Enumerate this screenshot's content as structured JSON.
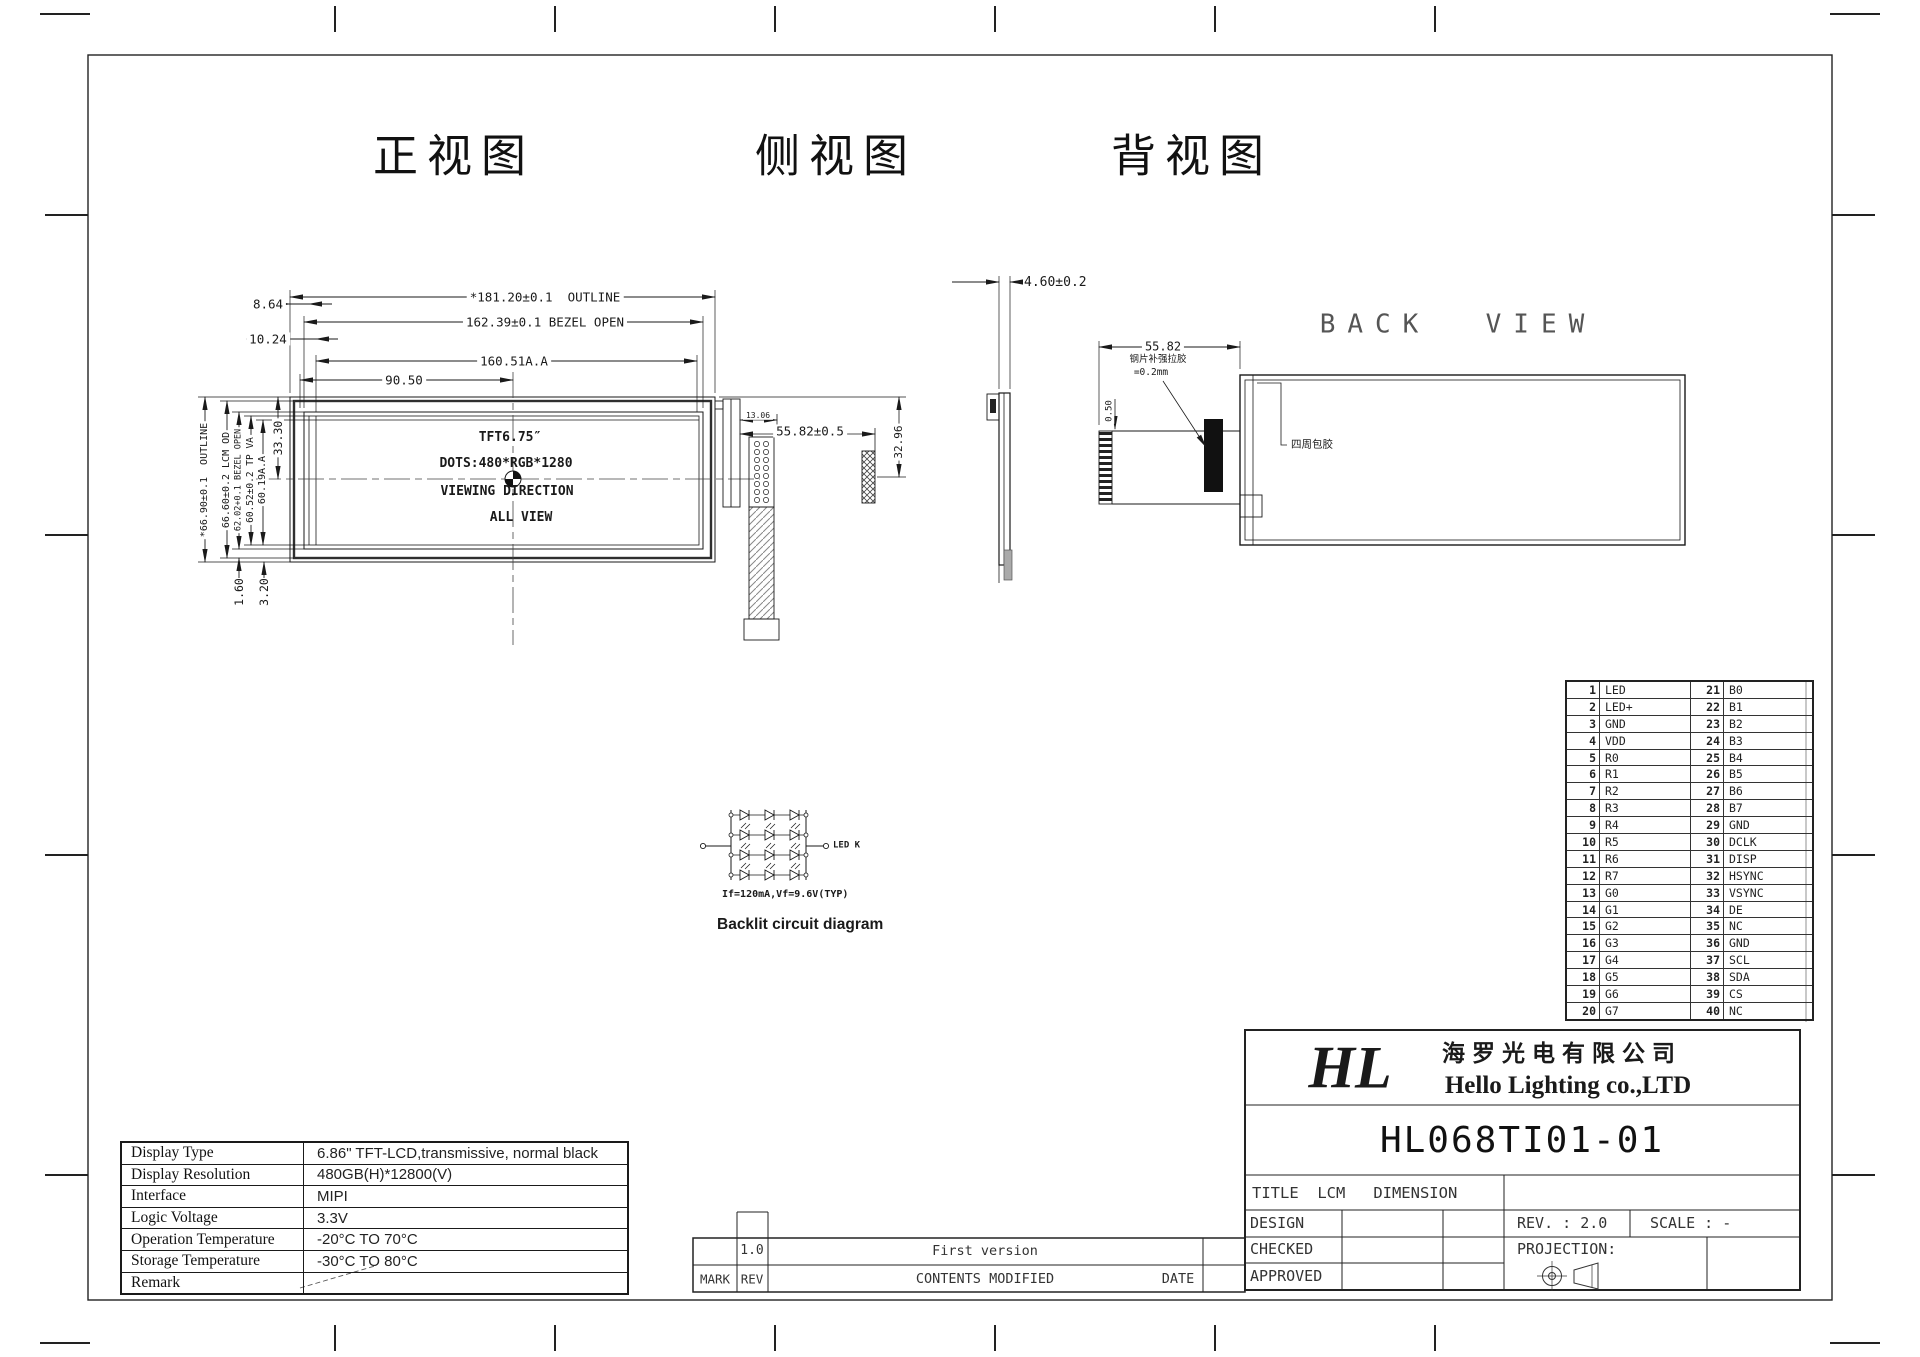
{
  "views": {
    "front_title": "正视图",
    "side_title": "侧视图",
    "back_title": "背视图",
    "back_view_label": "BACK  VIEW"
  },
  "front": {
    "center": [
      "TFT6.75″",
      "DOTS:480*RGB*1280",
      "VIEWING DIRECTION",
      "ALL VIEW"
    ],
    "dim_outline_w": "*181.20±0.1  OUTLINE",
    "dim_bezel_w": "162.39±0.1 BEZEL OPEN",
    "dim_aa_w": "160.51A.A",
    "dim_half": "90.50",
    "dim_8_64": "8.64",
    "dim_10_24": "10.24",
    "dim_outline_h": "*66.90±0.1  OUTLINE",
    "dim_lcm_h": "66.60±0.2 LCM OD",
    "dim_bezel_h": "62.02+0.1 BEZEL OPEN",
    "dim_tp_h": "60.52±0.2 TP VA",
    "dim_aa_h": "60.19A.A",
    "dim_33_30": "33.30",
    "dim_1_60": "1.60",
    "dim_3_20": "3.20",
    "dim_fpc_w": "55.82±0.5",
    "dim_13_06": "13.06",
    "dim_fpc_h": "32.96"
  },
  "side": {
    "dim_thickness": "4.60±0.2"
  },
  "back": {
    "dim_w": "55.82",
    "note1": "钢片补强拉胶",
    "note2": "=0.2mm",
    "dim_0_50": "0.50",
    "glue_label": "四周包胶"
  },
  "backlight": {
    "caption": "Backlit circuit diagram",
    "spec": "If=120mA,Vf=9.6V(TYP)",
    "terminal": "LED K"
  },
  "pin_table": {
    "rows": [
      {
        "n1": "1",
        "p1": "LED",
        "n2": "21",
        "p2": "B0"
      },
      {
        "n1": "2",
        "p1": "LED+",
        "n2": "22",
        "p2": "B1"
      },
      {
        "n1": "3",
        "p1": "GND",
        "n2": "23",
        "p2": "B2"
      },
      {
        "n1": "4",
        "p1": "VDD",
        "n2": "24",
        "p2": "B3"
      },
      {
        "n1": "5",
        "p1": "R0",
        "n2": "25",
        "p2": "B4"
      },
      {
        "n1": "6",
        "p1": "R1",
        "n2": "26",
        "p2": "B5"
      },
      {
        "n1": "7",
        "p1": "R2",
        "n2": "27",
        "p2": "B6"
      },
      {
        "n1": "8",
        "p1": "R3",
        "n2": "28",
        "p2": "B7"
      },
      {
        "n1": "9",
        "p1": "R4",
        "n2": "29",
        "p2": "GND"
      },
      {
        "n1": "10",
        "p1": "R5",
        "n2": "30",
        "p2": "DCLK"
      },
      {
        "n1": "11",
        "p1": "R6",
        "n2": "31",
        "p2": "DISP"
      },
      {
        "n1": "12",
        "p1": "R7",
        "n2": "32",
        "p2": "HSYNC"
      },
      {
        "n1": "13",
        "p1": "G0",
        "n2": "33",
        "p2": "VSYNC"
      },
      {
        "n1": "14",
        "p1": "G1",
        "n2": "34",
        "p2": "DE"
      },
      {
        "n1": "15",
        "p1": "G2",
        "n2": "35",
        "p2": "NC"
      },
      {
        "n1": "16",
        "p1": "G3",
        "n2": "36",
        "p2": "GND"
      },
      {
        "n1": "17",
        "p1": "G4",
        "n2": "37",
        "p2": "SCL"
      },
      {
        "n1": "18",
        "p1": "G5",
        "n2": "38",
        "p2": "SDA"
      },
      {
        "n1": "19",
        "p1": "G6",
        "n2": "39",
        "p2": "CS"
      },
      {
        "n1": "20",
        "p1": "G7",
        "n2": "40",
        "p2": "NC"
      }
    ]
  },
  "spec_table": {
    "rows": [
      {
        "label": "Display Type",
        "value": "6.86\" TFT-LCD,transmissive, normal black"
      },
      {
        "label": "Display Resolution",
        "value": "480GB(H)*12800(V)"
      },
      {
        "label": "Interface",
        "value": "MIPI"
      },
      {
        "label": "Logic Voltage",
        "value": "3.3V"
      },
      {
        "label": "Operation Temperature",
        "value": "-20°C  TO  70°C"
      },
      {
        "label": "Storage Temperature",
        "value": "-30°C  TO  80°C"
      },
      {
        "label": "Remark",
        "value": ""
      }
    ]
  },
  "title_block": {
    "logo": "HL",
    "company_cn": "海罗光电有限公司",
    "company_en": "Hello Lighting co.,LTD",
    "part_number": "HL068TI01-01",
    "title_row": "TITLE  LCM   DIMENSION",
    "design": "DESIGN",
    "checked": "CHECKED",
    "approved": "APPROVED",
    "rev": "REV. : 2.0",
    "scale": "SCALE : -",
    "projection": "PROJECTION:"
  },
  "revision": {
    "rev_value": "1.0",
    "content_value": "First version",
    "mark": "MARK",
    "rev": "REV",
    "contents": "CONTENTS MODIFIED",
    "date": "DATE"
  }
}
